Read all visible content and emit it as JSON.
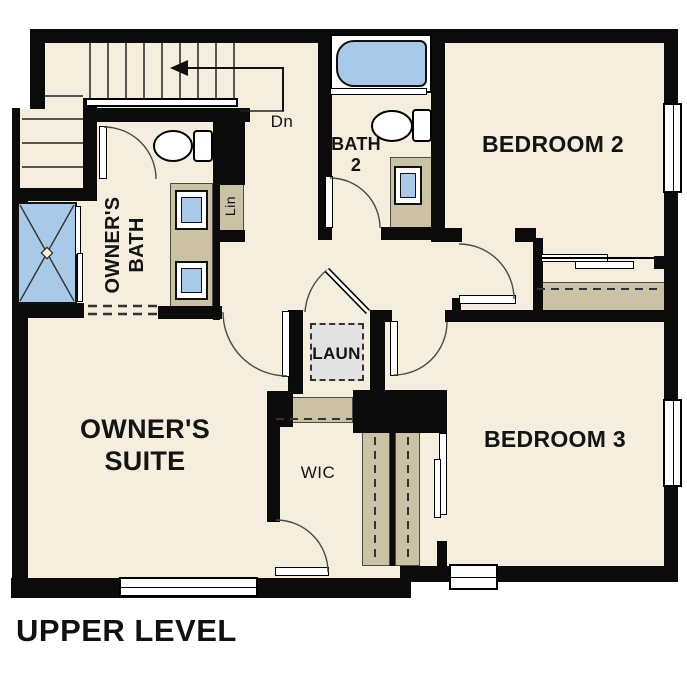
{
  "title": "UPPER LEVEL",
  "rooms": {
    "owners_suite": {
      "label": "OWNER'S\nSUITE"
    },
    "owners_bath": {
      "label": "OWNER'S\nBATH"
    },
    "bath2": {
      "label": "BATH\n2"
    },
    "bedroom2": {
      "label": "BEDROOM 2"
    },
    "bedroom3": {
      "label": "BEDROOM 3"
    },
    "laundry": {
      "label": "LAUN"
    },
    "wic": {
      "label": "WIC"
    },
    "linen": {
      "label": "Lin"
    }
  },
  "stairs": {
    "direction_label": "Dn"
  },
  "fixtures": {
    "shower": "shower-pan-icon",
    "bathtub": "bathtub-icon",
    "toilet": "toilet-icon",
    "sink": "sink-icon",
    "washer_dryer": "washer-dryer-icon",
    "window": "window-icon",
    "door": "door-swing-icon",
    "staircase": "staircase-icon"
  },
  "colors": {
    "floor": "#f5eddd",
    "wall": "#0b0b0b",
    "cabinet_tan": "#cbc1a7",
    "fixture_blue": "#a9c9e9",
    "appliance_gray": "#e2e2e3"
  }
}
